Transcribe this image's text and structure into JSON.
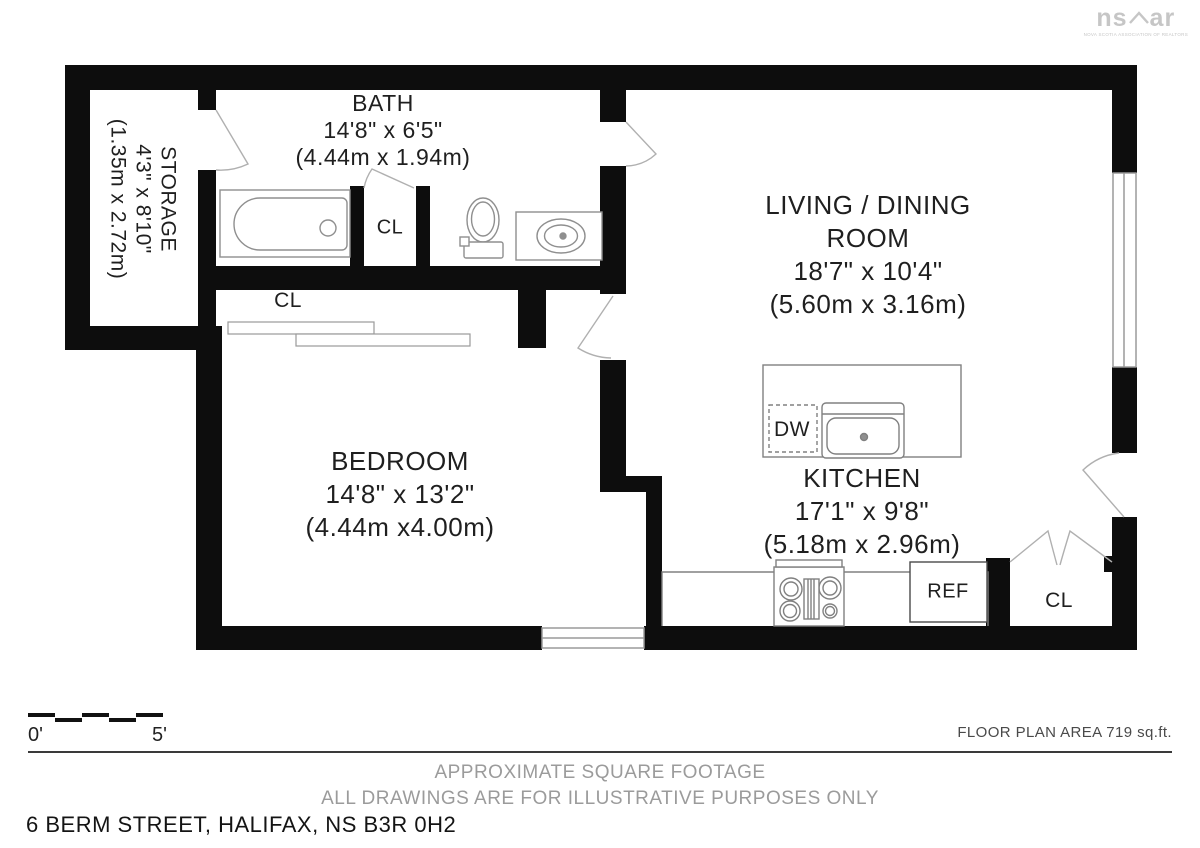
{
  "logo": {
    "text_left": "ns",
    "text_right": "ar",
    "subtext": "NOVA SCOTIA ASSOCIATION OF REALTORS"
  },
  "rooms": {
    "storage": {
      "name": "STORAGE",
      "imperial": "4'3\" x 8'10\"",
      "metric": "(1.35m x 2.72m)"
    },
    "bath": {
      "name": "BATH",
      "imperial": "14'8\" x 6'5\"",
      "metric": "(4.44m x 1.94m)"
    },
    "living": {
      "name_line1": "LIVING / DINING",
      "name_line2": "ROOM",
      "imperial": "18'7\" x 10'4\"",
      "metric": "(5.60m x 3.16m)"
    },
    "bedroom": {
      "name": "BEDROOM",
      "imperial": "14'8\" x 13'2\"",
      "metric": "(4.44m x4.00m)"
    },
    "kitchen": {
      "name": "KITCHEN",
      "imperial": "17'1\" x 9'8\"",
      "metric": "(5.18m x 2.96m)"
    }
  },
  "closets": {
    "bath_closet": "CL",
    "bedroom_closet": "CL",
    "entry_closet": "CL"
  },
  "appliances": {
    "dishwasher": "DW",
    "refrigerator": "REF"
  },
  "scale_bar": {
    "start_label": "0'",
    "end_label": "5'"
  },
  "footer": {
    "area_note": "FLOOR PLAN AREA 719 sq.ft.",
    "disclaimer_line1": "APPROXIMATE SQUARE FOOTAGE",
    "disclaimer_line2": "ALL DRAWINGS ARE FOR ILLUSTRATIVE PURPOSES ONLY",
    "address": "6 BERM STREET, HALIFAX, NS B3R 0H2"
  },
  "colors": {
    "wall": "#0d0d0d",
    "fixture": "#8f8f8f",
    "door_swing": "#b0b0b0",
    "text": "#1f1f1f",
    "muted_text": "#9b9b9b",
    "logo_gray": "#c6c6c6"
  }
}
